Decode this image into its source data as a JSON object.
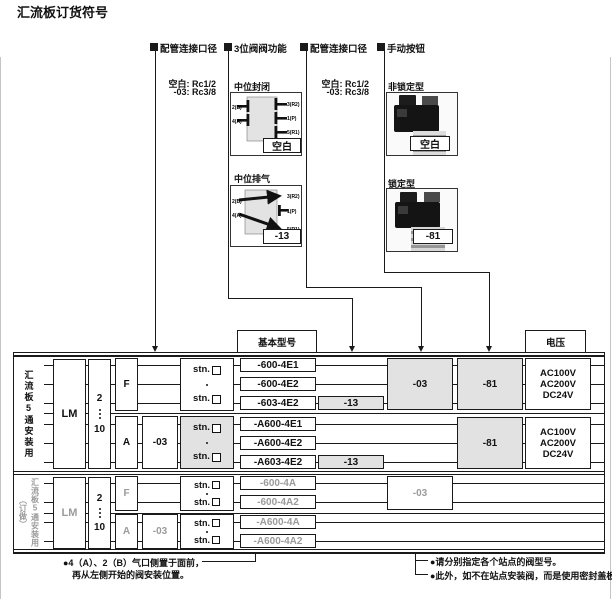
{
  "title": "汇流板订货符号",
  "callouts": {
    "pipe1": {
      "label": "配管连接口径",
      "opt1": "空白: Rc1/2",
      "opt2": "-03: Rc3/8"
    },
    "valve3": {
      "label": "3位阀阀功能"
    },
    "pipe2": {
      "label": "配管连接口径",
      "opt1": "空白: Rc1/2",
      "opt2": "-03: Rc3/8"
    },
    "manual": {
      "label": "手动按钮"
    }
  },
  "valve_functions": {
    "closed": {
      "name": "中位封闭",
      "code": "空白",
      "p2": "2(B)",
      "p4": "4(A)",
      "p3": "3(R2)",
      "p1": "1(P)",
      "p5": "5(R1)"
    },
    "exhaust": {
      "name": "中位排气",
      "code": "-13",
      "p2": "2(B)",
      "p4": "4(A)",
      "p3": "3(R2)",
      "p1": "1(P)",
      "p5": "5(R1)"
    }
  },
  "manual_buttons": {
    "nonlock": {
      "name": "非锁定型",
      "code": "空白"
    },
    "lock": {
      "name": "锁定型",
      "code": "-81"
    }
  },
  "headers": {
    "basic_model": "基本型号",
    "voltage": "电压"
  },
  "upper": {
    "side_label": "汇流板5通安装用",
    "series": "LM",
    "st_from": "2",
    "st_to": "10",
    "f": "F",
    "a": "A",
    "a_port": "-03",
    "stn": "stn.",
    "m1": "-600-4E1",
    "m2": "-600-4E2",
    "m3": "-603-4E2",
    "m4": "-A600-4E1",
    "m5": "-A600-4E2",
    "m6": "-A603-4E2",
    "c13": "-13",
    "c03": "-03",
    "c81": "-81",
    "v1": "AC100V",
    "v2": "AC200V",
    "v3": "DC24V"
  },
  "lower": {
    "side_label": "汇流板5通安装用",
    "side_note": "（订做）",
    "series": "LM",
    "st_from": "2",
    "st_to": "10",
    "f": "F",
    "a": "A",
    "a_port": "-03",
    "stn": "stn.",
    "m1": "-600-4A",
    "m2": "-600-4A2",
    "m3": "-A600-4A",
    "m4": "-A600-4A2",
    "c03": "-03"
  },
  "notes": {
    "left1": "●4（A）、2（B）气口侧置于面前，",
    "left2": "再从左侧开始的阀安装位置。",
    "right1": "●请分别指定各个站点的阀型号。",
    "right2": "●此外，如不在站点安装阀，而是使用密封盖板进行关闭时，请填写-BP。"
  },
  "colors": {
    "gray_fill": "#e2e2e2",
    "muted_text": "#9b9b9b",
    "line": "#1a1a1a"
  }
}
